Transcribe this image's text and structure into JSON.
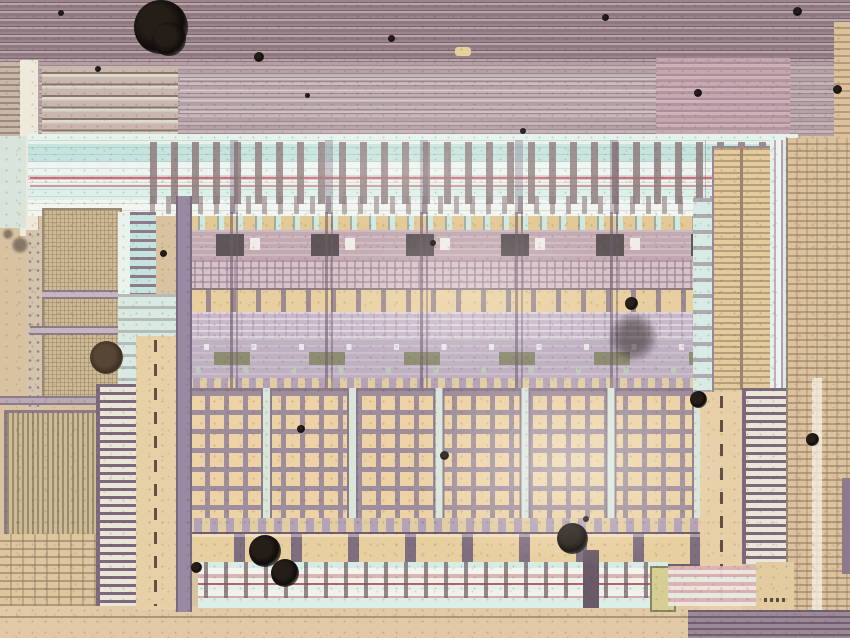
{
  "meta": {
    "title": "Optical microscope photograph of an integrated circuit die",
    "description": "Microphotograph showing horizontal metal bus stripes at top, a cyan routing channel with vertical taps, five repeated standard-cell columns with an orange contact row, large tan contact-grid blocks, interdigitated comb structures, dashed-line tan columns, fine hatch bands at the edges, and scattered dust particles. No text is visible in the image."
  },
  "palette": {
    "base_tan": "#d8c2a0",
    "stripe_mauve": "#9a838b",
    "stripe_dark": "#7c666e",
    "stripe_light": "#b7a5aa",
    "pink_band": "#c9a8b0",
    "cyan_light": "#def0ea",
    "cyan_mid": "#c6e4de",
    "red_line": "#bb5f68",
    "lavender": "#c6b5c8",
    "lavender_dark": "#a793aa",
    "purple_line": "#8d7a8d",
    "grid_tan": "#ecd2a4",
    "khaki": "#cdbb95",
    "orange_pad": "#e8cf9f",
    "olive": "#8d8d72",
    "cream": "#efe9dc",
    "yellow_green": "#d6cf94"
  },
  "structures": {
    "cell_columns": 5,
    "grid_blocks": 6,
    "regions": [
      "top-metal-bus-stripes",
      "mid-metal-stripes",
      "pink-stripe-patch",
      "cyan-routing-channel",
      "vertical-tap-teeth",
      "finger-traces",
      "standard-cell-rows",
      "orange-contact-row",
      "gate-component-row",
      "contact-grid-array",
      "orange-pad-row",
      "bottom-routing-channel",
      "left-comb-zipper",
      "right-comb-zipper",
      "dashed-tan-columns",
      "fine-khaki-grid",
      "vertical-stripe-block",
      "edge-hatch-band"
    ]
  },
  "dust_spots": [
    {
      "x": 134,
      "y": 0,
      "d": 54,
      "kind": "black"
    },
    {
      "x": 152,
      "y": 22,
      "d": 34,
      "kind": "black"
    },
    {
      "x": 254,
      "y": 52,
      "d": 10,
      "kind": "black"
    },
    {
      "x": 58,
      "y": 10,
      "d": 6,
      "kind": "black"
    },
    {
      "x": 95,
      "y": 66,
      "d": 6,
      "kind": "black"
    },
    {
      "x": 305,
      "y": 93,
      "d": 5,
      "kind": "black"
    },
    {
      "x": 388,
      "y": 35,
      "d": 7,
      "kind": "black"
    },
    {
      "x": 602,
      "y": 14,
      "d": 7,
      "kind": "black"
    },
    {
      "x": 694,
      "y": 89,
      "d": 8,
      "kind": "black"
    },
    {
      "x": 793,
      "y": 7,
      "d": 9,
      "kind": "black"
    },
    {
      "x": 833,
      "y": 85,
      "d": 9,
      "kind": "black"
    },
    {
      "x": 520,
      "y": 128,
      "d": 6,
      "kind": "black"
    },
    {
      "x": 12,
      "y": 237,
      "d": 16,
      "kind": "gray"
    },
    {
      "x": 3,
      "y": 229,
      "d": 10,
      "kind": "gray"
    },
    {
      "x": 160,
      "y": 250,
      "d": 7,
      "kind": "black"
    },
    {
      "x": 430,
      "y": 240,
      "d": 6,
      "kind": "black"
    },
    {
      "x": 90,
      "y": 341,
      "d": 33,
      "kind": "brown"
    },
    {
      "x": 610,
      "y": 314,
      "d": 46,
      "kind": "smudge"
    },
    {
      "x": 625,
      "y": 297,
      "d": 13,
      "kind": "black"
    },
    {
      "x": 690,
      "y": 391,
      "d": 17,
      "kind": "black"
    },
    {
      "x": 806,
      "y": 433,
      "d": 13,
      "kind": "black"
    },
    {
      "x": 297,
      "y": 425,
      "d": 8,
      "kind": "black"
    },
    {
      "x": 440,
      "y": 451,
      "d": 9,
      "kind": "black"
    },
    {
      "x": 583,
      "y": 516,
      "d": 6,
      "kind": "black"
    },
    {
      "x": 557,
      "y": 523,
      "d": 31,
      "kind": "black"
    },
    {
      "x": 249,
      "y": 535,
      "d": 32,
      "kind": "black"
    },
    {
      "x": 271,
      "y": 559,
      "d": 28,
      "kind": "black"
    },
    {
      "x": 191,
      "y": 562,
      "d": 11,
      "kind": "black"
    }
  ]
}
